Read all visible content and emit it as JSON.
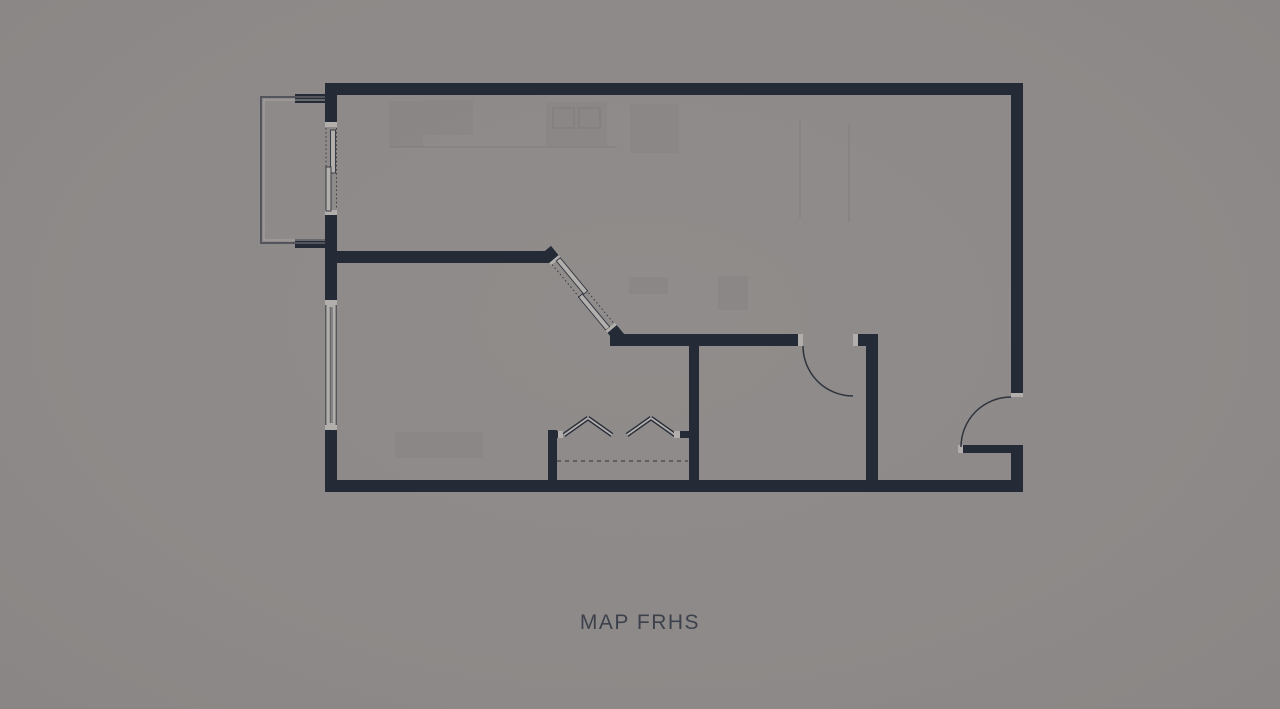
{
  "plan": {
    "title": "MAP FRHS",
    "kind": "apartment floor plan",
    "features": [
      "balcony-railing",
      "balcony-sliding-door",
      "left-wall-window",
      "diagonal-sliding-door",
      "interior-door-swing",
      "entry-door-swing",
      "closet-bifold-doors",
      "closet-shelf-dashed-line"
    ]
  },
  "colors": {
    "background": "#8E8A89",
    "wall": "#252B36",
    "wall_cap": "#B2AEAC",
    "door_panel": "#B3AFAD",
    "outline": "#2E333C",
    "railing": "#54545C",
    "railing_inner": "#A8A4A2",
    "title_text": "#3C414B"
  }
}
